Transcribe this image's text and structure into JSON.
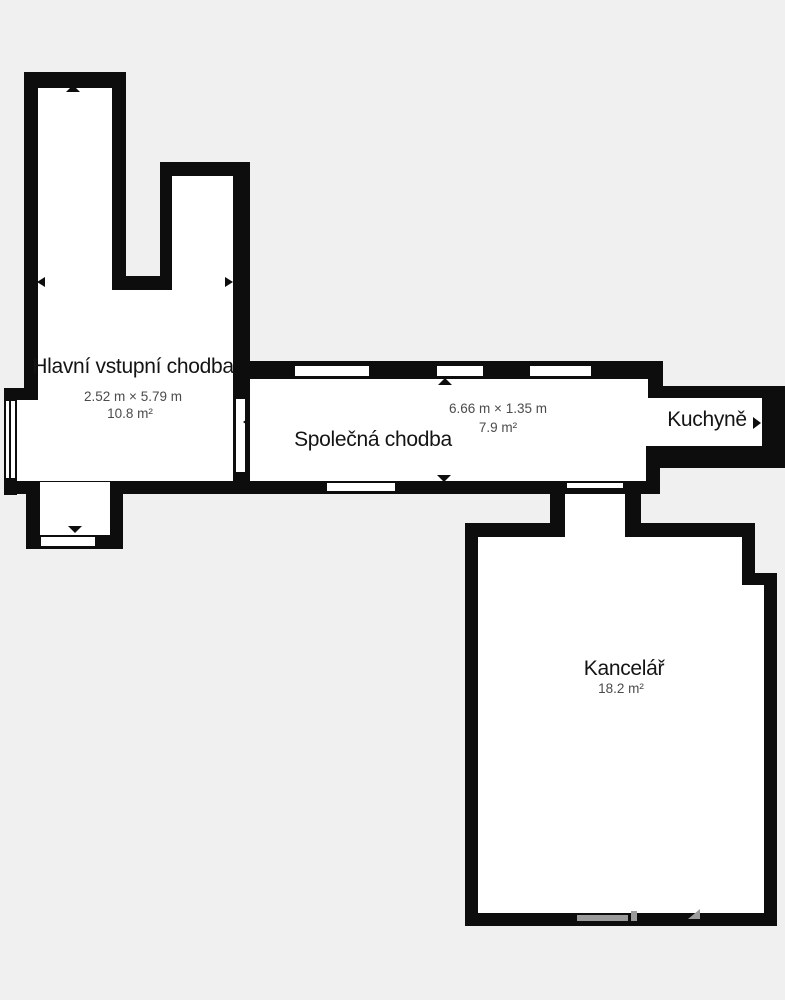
{
  "floorplan": {
    "background_color": "#f0f0f0",
    "wall_color": "#0d0d0d",
    "room_fill_color": "#ffffff",
    "room_name_color": "#141414",
    "dimension_text_color": "#4b4b4b",
    "watermark_color": "#9b9b9b",
    "rooms": [
      {
        "name": "Hlavní vstupní chodba",
        "dimensions": "2.52 m × 5.79 m",
        "area": "10.8 m²"
      },
      {
        "name": "Společná chodba",
        "dimensions": "6.66 m × 1.35 m",
        "area": "7.9 m²"
      },
      {
        "name": "Kuchyně"
      },
      {
        "name": "Kancelář",
        "area": "18.2 m²"
      }
    ],
    "icons": {
      "dimension_arrow_up": "triangle-up",
      "dimension_arrow_down": "triangle-down",
      "dimension_arrow_left": "triangle-left",
      "dimension_arrow_right": "triangle-right"
    }
  }
}
